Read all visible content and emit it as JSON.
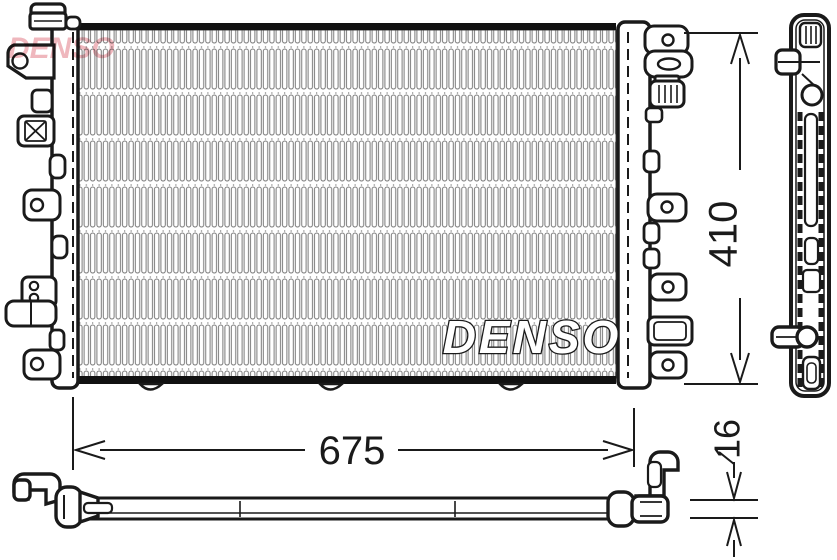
{
  "drawing": {
    "brand_logo_text": "DENSO",
    "core_watermark_text": "DENSO",
    "dimensions": {
      "height_mm": "410",
      "width_mm": "675",
      "depth_mm": "16"
    }
  },
  "colors": {
    "line": "#1a1a1a",
    "fin_stroke": "#7a7a7a",
    "logo_pink": "#edaab2",
    "background": "#ffffff"
  }
}
